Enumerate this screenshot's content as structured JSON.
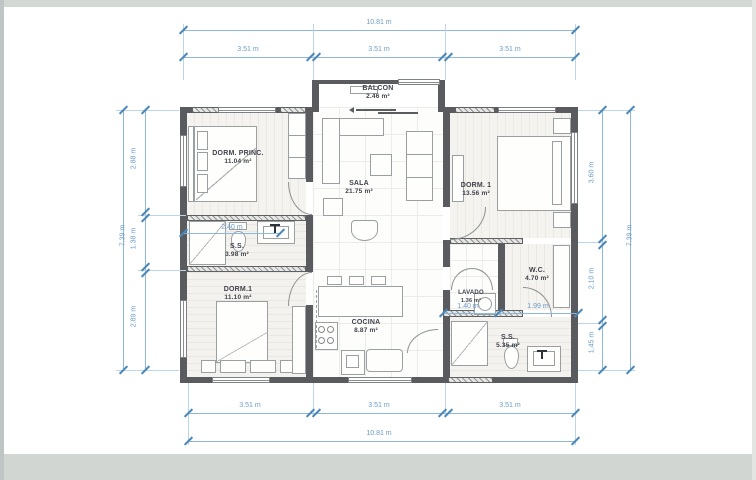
{
  "rooms": {
    "balcon": {
      "name": "BALCON",
      "area": "2.46 m²"
    },
    "dorm_princ": {
      "name": "DORM. PRINC.",
      "area": "11.04 m²"
    },
    "sala": {
      "name": "SALA",
      "area": "21.75 m²"
    },
    "dorm1_right": {
      "name": "DORM. 1",
      "area": "13.56 m²"
    },
    "bano_social": {
      "name": "S.S.",
      "area": "3.98 m²"
    },
    "dorm1_left": {
      "name": "DORM.1",
      "area": "11.10 m²"
    },
    "cocina": {
      "name": "COCINA",
      "area": "8.87 m²"
    },
    "wc": {
      "name": "W.C.",
      "area": "4.70 m²"
    },
    "lavado": {
      "name": "LAVADO",
      "area": "1.36 m²"
    },
    "ss_right": {
      "name": "S.S.",
      "area": "5.35 m²"
    }
  },
  "dims": {
    "top": {
      "total": "10.81 m",
      "segs": [
        "3.51 m",
        "3.51 m",
        "3.51 m"
      ]
    },
    "bottom": {
      "total": "10.81 m",
      "segs": [
        "3.51 m",
        "3.51 m",
        "3.51 m"
      ]
    },
    "left": {
      "total": "7.39 m",
      "segs": [
        "2.88 m",
        "1.38 m",
        "2.89 m"
      ]
    },
    "right": {
      "total": "7.39 m",
      "segs": [
        "3.60 m",
        "2.10 m",
        "1.45 m"
      ]
    },
    "interior": {
      "bath": "2.40 m",
      "lavado": "1.40 m",
      "wc": "1.99 m"
    }
  },
  "colors": {
    "dimension_blue": "#6b9cc7",
    "wall_gray": "#595b5e",
    "paper": "#ffffff"
  }
}
